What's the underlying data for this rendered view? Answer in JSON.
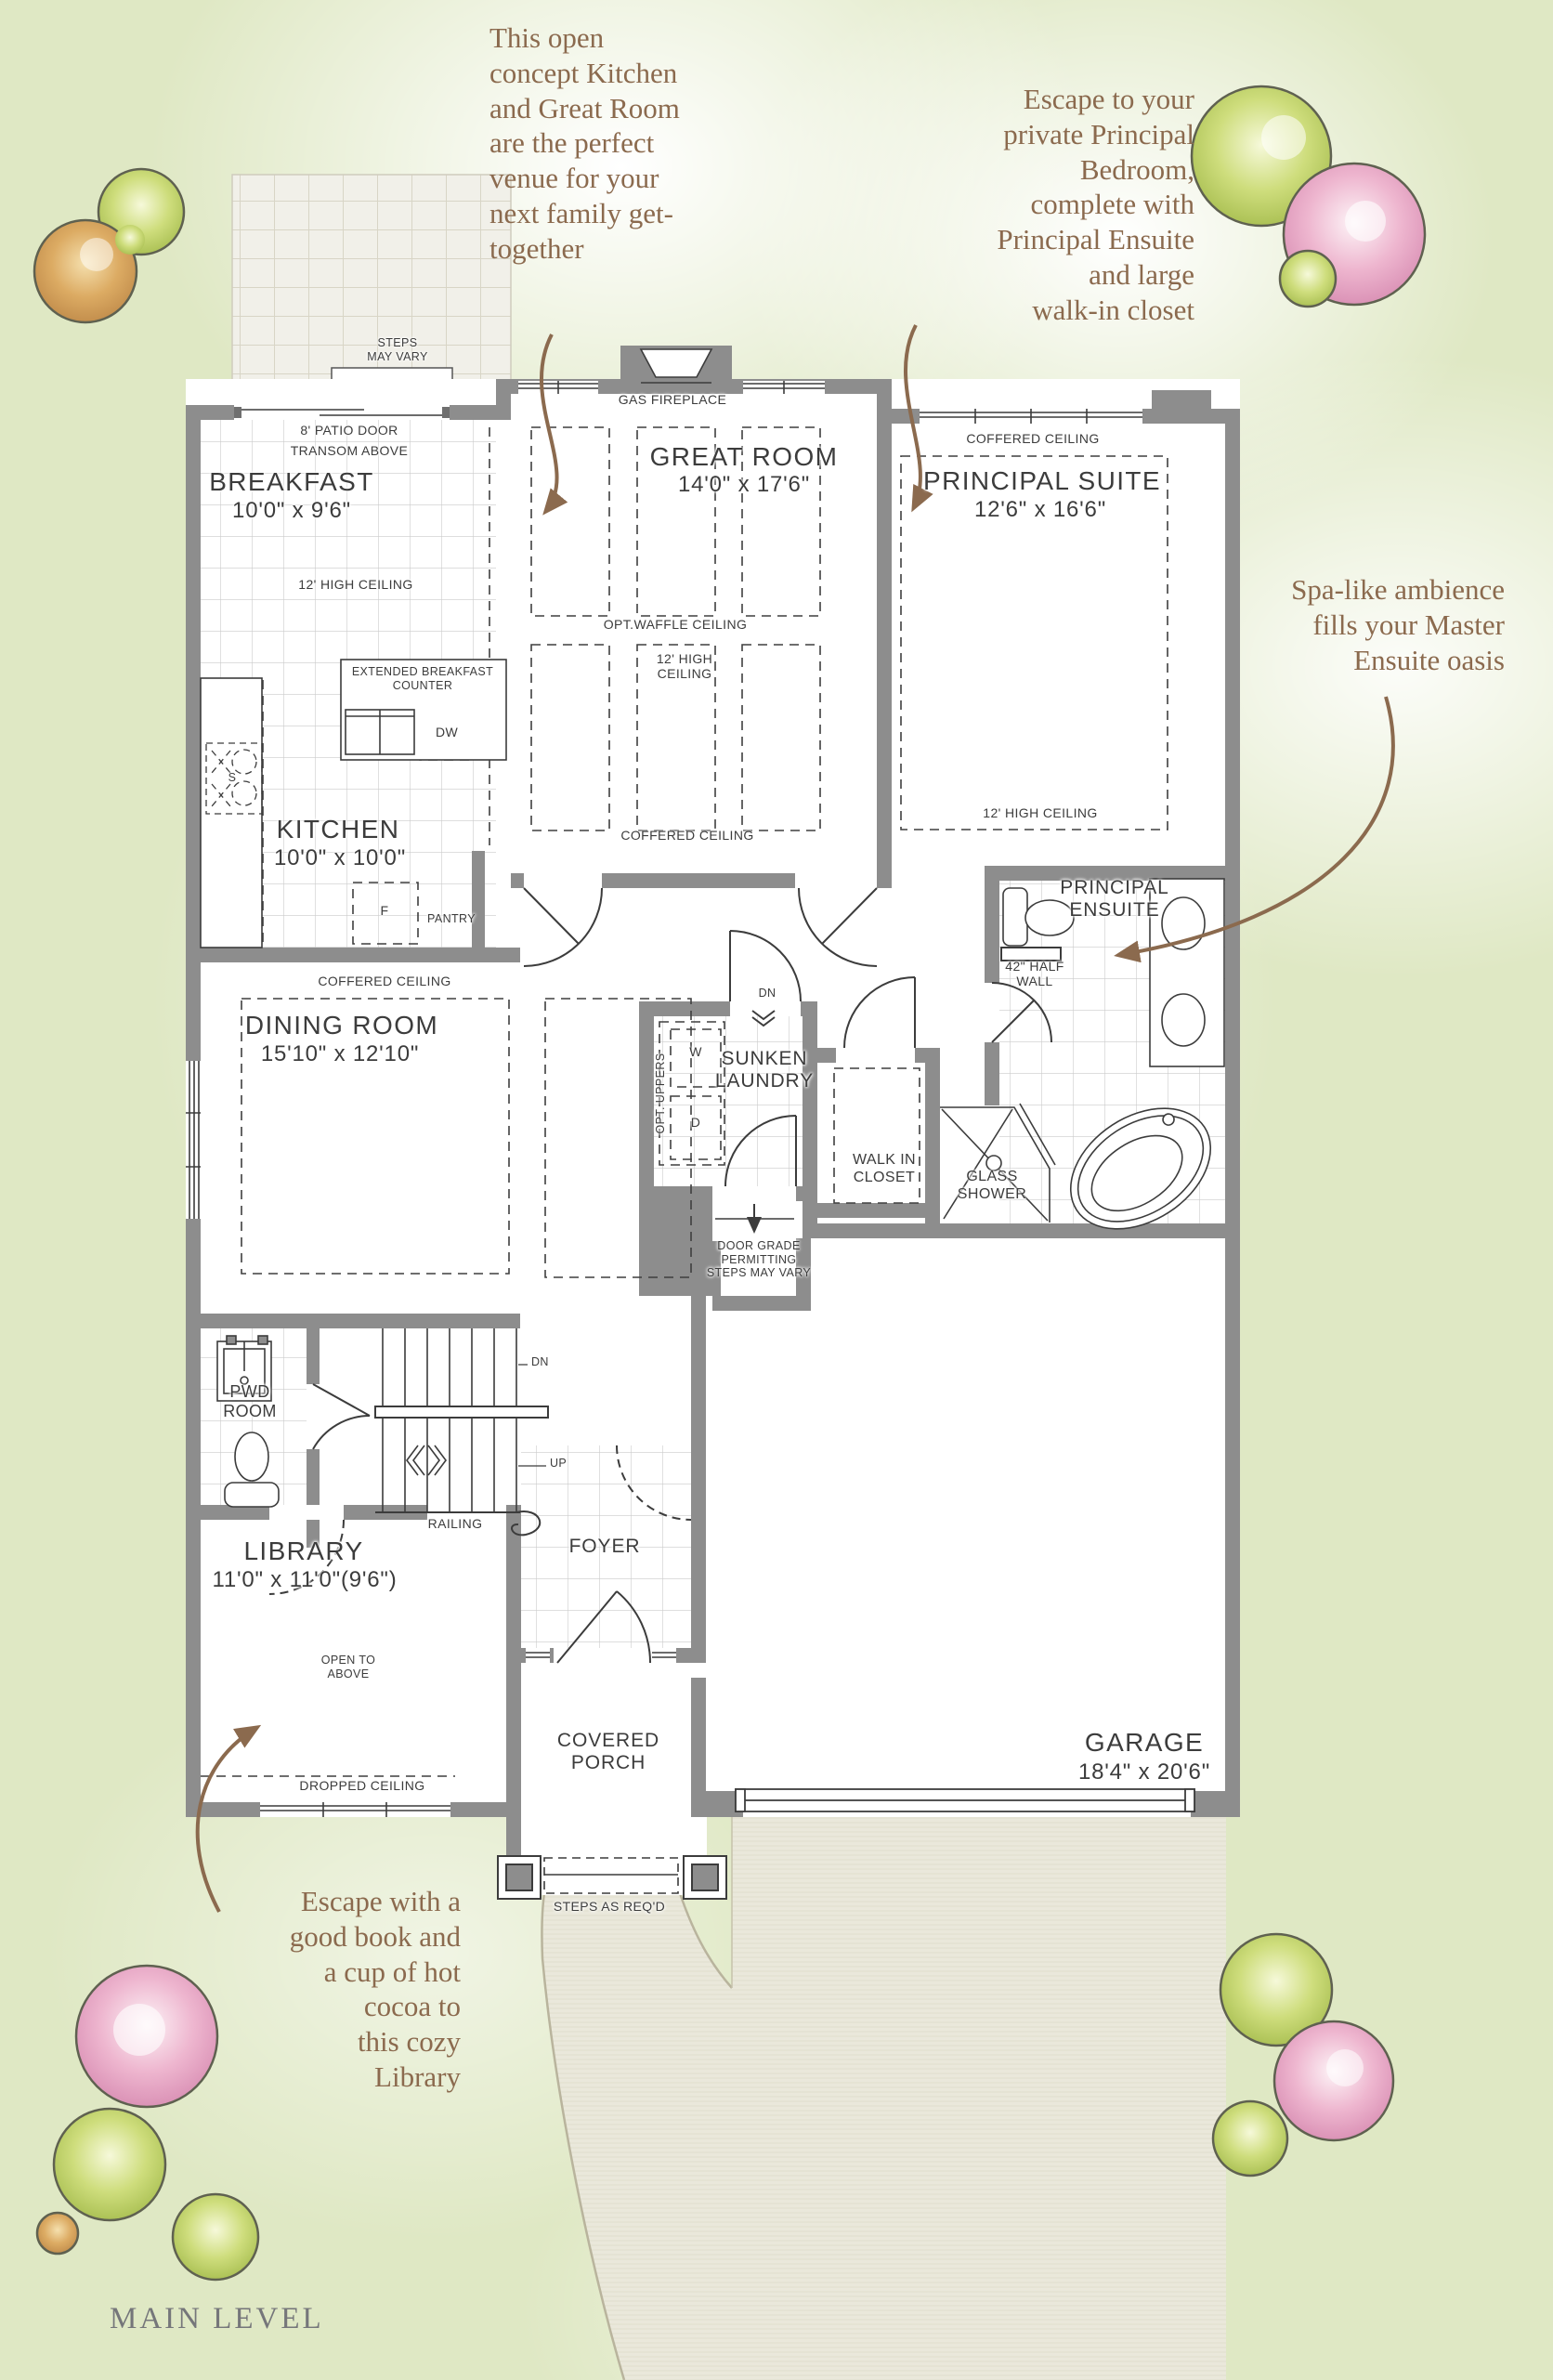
{
  "page": {
    "plan_title": "MAIN LEVEL"
  },
  "annotations": {
    "kitchen_great_room": "This open\nconcept Kitchen\nand Great Room\nare the perfect\nvenue for your\nnext family get-\ntogether",
    "principal_bedroom": "Escape to your\nprivate Principal\nBedroom,\ncomplete with\nPrincipal Ensuite\nand large\nwalk-in closet",
    "master_ensuite": "Spa-like ambience\nfills your Master\nEnsuite oasis",
    "library": "Escape with a\ngood book and\na cup of hot\ncocoa to\nthis cozy\nLibrary"
  },
  "rooms": {
    "breakfast": {
      "name": "BREAKFAST",
      "dims": "10'0\" x 9'6\""
    },
    "great_room": {
      "name": "GREAT ROOM",
      "dims": "14'0\" x 17'6\""
    },
    "principal_suite": {
      "name": "PRINCIPAL SUITE",
      "dims": "12'6\" x 16'6\""
    },
    "kitchen": {
      "name": "KITCHEN",
      "dims": "10'0\" x 10'0\""
    },
    "dining_room": {
      "name": "DINING ROOM",
      "dims": "15'10\" x 12'10\""
    },
    "principal_ensuite": {
      "name": "PRINCIPAL\nENSUITE"
    },
    "sunken_laundry": {
      "name": "SUNKEN\nLAUNDRY"
    },
    "walk_in_closet": {
      "name": "WALK IN\nCLOSET"
    },
    "pwd_room": {
      "name": "PWD\nROOM"
    },
    "library": {
      "name": "LIBRARY",
      "dims": "11'0\" x 11'0\"(9'6\")"
    },
    "foyer": {
      "name": "FOYER"
    },
    "covered_porch": {
      "name": "COVERED\nPORCH"
    },
    "garage": {
      "name": "GARAGE",
      "dims": "18'4\" x 20'6\""
    }
  },
  "labels": {
    "patio_steps": "STEPS\nMAY VARY",
    "patio_door": "8' PATIO DOOR",
    "transom": "TRANSOM ABOVE",
    "breakfast_ceiling": "12' HIGH CEILING",
    "gas_fireplace": "GAS FIREPLACE",
    "opt_waffle": "OPT.WAFFLE CEILING",
    "great_room_ceiling": "12' HIGH\nCEILING",
    "great_room_coffered": "COFFERED CEILING",
    "suite_coffered": "COFFERED CEILING",
    "suite_ceiling": "12' HIGH CEILING",
    "extended_counter": "EXTENDED BREAKFAST\nCOUNTER",
    "dishwasher": "DW",
    "sink": "S",
    "fridge": "F",
    "pantry": "PANTRY",
    "dining_coffered": "COFFERED CEILING",
    "dn_hall": "DN",
    "opt_uppers": "OPT. UPPERS",
    "washer": "W",
    "dryer": "D",
    "half_wall": "42\" HALF\nWALL",
    "glass_shower": "GLASS\nSHOWER",
    "door_grade": "DOOR GRADE\nPERMITTING\nSTEPS MAY VARY",
    "dn_stairs": "DN",
    "up_stairs": "UP",
    "railing": "RAILING",
    "open_to_above": "OPEN TO\nABOVE",
    "dropped_ceiling": "DROPPED CEILING",
    "steps_reqd": "STEPS AS REQ'D"
  },
  "colors": {
    "annotation_brown": "#8b6a4e",
    "wall_gray": "#8d8d8d",
    "label_dark": "#3c3c3c",
    "background_green": "#dfe8c4",
    "title_gray": "#75767a",
    "driveway_beige": "#eae8db",
    "paver": "#f1f0e9"
  }
}
